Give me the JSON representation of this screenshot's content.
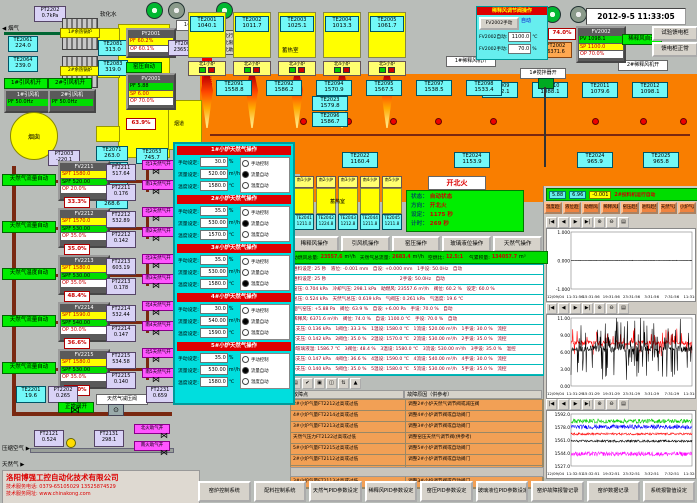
{
  "window": {
    "datetime": "2012-9-5 11:33:05"
  },
  "icons": {
    "valve": "⋈",
    "meter": "⊙",
    "arrow_left": "◀",
    "arrow_right": "▶"
  },
  "chart_toolbar_icons": [
    "|◀",
    "◀",
    "▶",
    "▶|",
    "⊕",
    "⊖",
    "▤"
  ],
  "top_left": {
    "smoke": "◀ 烟气",
    "pt2202_t": "PT2202",
    "pt2202_v": "0.7kPa",
    "soft_water": "软化水",
    "boiler1": "1#余热锅炉",
    "boiler2": "2#余热锅炉",
    "te2061_t": "TE2061",
    "te2061_v": "224.0",
    "te2064_t": "TE2064",
    "te2064_v": "239.0",
    "te2081_t": "TE2081",
    "te2081_v": "313.0",
    "te2083_t": "TE2083",
    "te2083_v": "319.0",
    "fan1_on": "1#引风机开",
    "fan2_on": "2#引风机开",
    "fan1_t": "1#引风机",
    "fan1_v": "PF 50.0Hz",
    "fan2_t": "2#引风机",
    "fan2_v": "PF 50.0Hz",
    "chimney": "烟囱",
    "flue": "烟道",
    "pt2003_t": "PT2003",
    "pt2003_v": "-220.1",
    "te2053_t": "TE2053",
    "te2053_v": "745.7",
    "pct_flue": "63.9%",
    "kiln_auto": "窑压自动",
    "py2001_t": "PY2001",
    "py2001_r1": "PF 60.2%",
    "py2001_r2": "OP 60.1%",
    "ft2001_t": "FT2001",
    "ft2001_v": "23657.6",
    "pv2001_t": "PV2001",
    "pv2001_r1": "PF 5.88",
    "pv2001_r2": "SP 6.00",
    "pv2001_r3": "OP 70.0%",
    "comb_fan_on": "1#助燃风机开",
    "comb_air_open": "助燃风开",
    "legend": [
      {
        "label": "北行程",
        "cls": "sq-gray"
      },
      {
        "label": "北限位",
        "cls": "sq-gray"
      },
      {
        "label": "北助燃",
        "cls": "sq-green"
      }
    ]
  },
  "north": {
    "room": "蓄热室",
    "chambers": [
      {
        "t": "TE2001",
        "v": "1040.1",
        "f": "北1小炉"
      },
      {
        "t": "TE2002",
        "v": "1011.7",
        "f": "北2小炉"
      },
      {
        "t": "TE2003",
        "v": "1025.1",
        "f": "北3小炉"
      },
      {
        "t": "TE2004",
        "v": "1013.3",
        "f": "北4小炉"
      },
      {
        "t": "TE2005",
        "v": "1061.7",
        "f": "北5小炉"
      }
    ]
  },
  "south": {
    "room": "蓄热室",
    "chambers": [
      {
        "f": "南1小炉",
        "t": "TE2041",
        "v": "1211.0"
      },
      {
        "f": "南2小炉",
        "t": "TE2042",
        "v": "1224.8"
      },
      {
        "f": "南3小炉",
        "t": "TE2043",
        "v": "1212.8"
      },
      {
        "f": "南4小炉",
        "t": "TE2044",
        "v": "1211.8"
      },
      {
        "f": "南5小炉",
        "t": "TE2045",
        "v": "1211.8"
      }
    ]
  },
  "furnace": {
    "left_stack": [
      {
        "t": "TE2071",
        "v": "263.0"
      },
      {
        "t": "TE2072",
        "v": "267.4"
      },
      {
        "t": "TE2073",
        "v": "269.6"
      },
      {
        "t": "TE2074",
        "v": "268.6"
      }
    ],
    "mid_temps": [
      {
        "t": "TE2091",
        "v": "1558.8"
      },
      {
        "t": "TE2092",
        "v": "1586.2"
      },
      {
        "t": "TE2094",
        "v": "1570.9"
      },
      {
        "t": "TE2095",
        "v": "1567.5"
      },
      {
        "t": "TE2097",
        "v": "1538.5"
      },
      {
        "t": "TE2098",
        "v": "1533.4"
      }
    ],
    "stack2": [
      {
        "t": "TE2023",
        "v": "1579.8"
      },
      {
        "t": "TE2096",
        "v": "1586.7"
      }
    ],
    "bottom_temps": [
      {
        "t": "TE2021",
        "v": "1168.3"
      },
      {
        "t": "TE2022",
        "v": "1160.4"
      },
      {
        "t": "TE2024",
        "v": "1153.9"
      }
    ],
    "right_temps": [
      {
        "t": "TE2009",
        "v": "1522.1"
      },
      {
        "t": "TE2010",
        "v": "1088.1"
      },
      {
        "t": "TE2011",
        "v": "1079.6"
      },
      {
        "t": "TE2012",
        "v": "1098.1"
      }
    ],
    "right_bottom": [
      {
        "t": "TE2024",
        "v": "965.9"
      },
      {
        "t": "TE2025",
        "v": "965.8"
      }
    ],
    "stirrer_on": "1#搅拌器开",
    "dilute_fan1": "1#稀释风机开",
    "dilute_fan2": "2#稀释风机开"
  },
  "dilution": {
    "title": "稀释风调节阀操作",
    "manual_btn": "FV2002手动",
    "mode": "自动",
    "auto_l": "FV2002自动:",
    "auto_v": "1100.0",
    "auto_u": "℃",
    "man_l": "FV2002手动:",
    "man_v": "70.0",
    "man_u": "%",
    "fv_t": "FV2002",
    "fv_pv": "PV 1098.1",
    "fv_sp": "SP 1100.0",
    "fv_op": "OP 70.0%",
    "auto_lbl": "稀释风自动",
    "ft2002_t": "FT2002",
    "ft2002_v": "6371.6",
    "pct": "74.0%",
    "btn1": "试验馈电柜",
    "btn2": "馈电柜正常"
  },
  "status": {
    "fire_btn": "开北火",
    "rows": [
      {
        "l": "状态：",
        "v": "自动状态"
      },
      {
        "l": "方向：",
        "v": "开北火"
      },
      {
        "l": "设定：",
        "v": "1175 秒"
      },
      {
        "l": "计时：",
        "v": "269 秒"
      }
    ]
  },
  "ops_buttons": [
    "稀释风操作",
    "引风机操作",
    "窑压操作",
    "玻璃液位操作",
    "天然气操作"
  ],
  "totals": [
    {
      "l": "助燃风总量:",
      "v": "23557.6",
      "u": "m³/h"
    },
    {
      "l": "天然气总流量:",
      "v": "2683.4",
      "u": "m³/h"
    },
    {
      "l": "空燃比:",
      "v": "12.5:1",
      "u": ""
    },
    {
      "l": "气累积量:",
      "v": "134057.7",
      "u": "m³"
    }
  ],
  "data_rows": [
    "进料设定: 25 秒　液位: -0.001 mm　自设: +0.000 mm　1手设: 50.0Hz　自动",
    "进料设定: 25 秒　　　　　　　　　　　　　　　　2手设: 50.0Hz　自动",
    "窑压: 0.704 kPa　冷却气压: 298.1 kPa　助燃风: 23557.6 m³/h　阀位: 60.2 %　设定: 60.0 %",
    "总压: 0.524 kPa　天然气总压: 0.619 kPa　气阀压: 0.261 kPa　气温度: 19.6 ℃",
    "烟气窑压: +5.88 Pa　阀位: 63.9 %　自设: +6.00 Pa　手设: 70.0 %　自动",
    "稀释风: 6371.6 m³/h　阀位: 74.0 %　自设: 1100.0 ℃　手设: 70.0 %　自动",
    "1支压: 0.136 kPa　1阀位: 33.3 %　1温设: 1580.0 ℃　1流设: 520.00 m³/h　1手设: 30.0 %　流控",
    "2支压: 0.142 kPa　2阀位: 35.0 %　2温设: 1570.0 ℃　2流设: 530.00 m³/h　2手设: 35.0 %　流控",
    "3玻璃液温: 1586.7 ℃　3阀位: 48.4 %　3温设: 1580.0 ℃　3流设: 530.00 m³/h　3手设: 35.0 %　温控",
    "4支压: 0.147 kPa　4阀位: 36.6 %　4温设: 1590.0 ℃　4流设: 540.00 m³/h　4手设: 30.0 %　流控",
    "5支压: 0.140 kPa　5阀位: 35.0 %　5温设: 1580.0 ℃　5流设: 530.00 m³/h　5手设: 35.0 %　流控"
  ],
  "alarm": {
    "toolbar": [
      "▤",
      "✔",
      "▣",
      "◫",
      "⇅",
      "▲"
    ],
    "headers": [
      "故障点",
      "故障原因（供参考）"
    ],
    "rows": [
      {
        "f": "2#小炉气量FT2212过高或过低",
        "c": "调整2#小炉天然气调节阀或减压阀"
      },
      {
        "f": "4#小炉气量FT2214过高或过低",
        "c": "调整4#小炉调节阀或自动阀门"
      },
      {
        "f": "3#小炉气量FT2213过高或过低",
        "c": "调整3#小炉调节阀或自动阀门"
      },
      {
        "f": "天然气压力FT2122过高或过低",
        "c": "调整窑压天然气调节阀(供参考)"
      },
      {
        "f": "5#小炉气量FT2215过高或过低",
        "c": "调整5#小炉调节阀或自动阀门"
      },
      {
        "f": "2#小炉气量FT2112过高或过低",
        "c": "调整2#小炉调节阀或自动阀门"
      },
      {
        "f": "1#小炉气量FT2111过高或过低",
        "c": "调整1#小炉调节阀或自动阀门"
      },
      {
        "f": "3#小炉气量FT2113过高或过低",
        "c": "调整3#小炉调节阀或自动阀门"
      }
    ]
  },
  "gas": {
    "trains": [
      {
        "mode": "天然气流量自动",
        "ctrl": "FV2211",
        "spt": "SPT 1580.0",
        "spf": "SPF 520.00",
        "op": "OP 20.0%",
        "pct": "33.3%",
        "ft_t": "FT2211",
        "ft_v": "517.64",
        "pt_t": "PT2211",
        "pt_v": "0.176",
        "vn": "北1天然气开",
        "vs": "南1天然气开"
      },
      {
        "mode": "天然气流量自动",
        "ctrl": "FV2212",
        "spt": "SPT 1570.0",
        "spf": "SPF 530.00",
        "op": "OP 35.0%",
        "pct": "35.0%",
        "ft_t": "FT2212",
        "ft_v": "532.89",
        "pt_t": "PT2212",
        "pt_v": "0.142",
        "vn": "北2天然气开",
        "vs": "南2天然气开"
      },
      {
        "mode": "天然气温度自动",
        "ctrl": "FV2213",
        "spt": "SPT 1580.0",
        "spf": "SPF 530.00",
        "op": "OP 35.0%",
        "pct": "48.4%",
        "ft_t": "FT2213",
        "ft_v": "603.19",
        "pt_t": "PT2213",
        "pt_v": "0.178",
        "vn": "北3天然气开",
        "vs": "南3天然气开"
      },
      {
        "mode": "天然气流量自动",
        "ctrl": "FV2214",
        "spt": "SPT 1590.0",
        "spf": "SPF 540.00",
        "op": "OP 30.0%",
        "pct": "36.6%",
        "ft_t": "FT2214",
        "ft_v": "532.44",
        "pt_t": "PT2214",
        "pt_v": "0.147",
        "vn": "北4天然气开",
        "vs": "南4天然气开"
      },
      {
        "mode": "天然气流量自动",
        "ctrl": "FV2215",
        "spt": "SPT 1580.0",
        "spf": "SPF 530.00",
        "op": "OP 35.0%",
        "pct": "35.0%",
        "ft_t": "FT2215",
        "ft_v": "534.58",
        "pt_t": "PT2215",
        "pt_v": "0.140",
        "vn": "北5天然气开",
        "vs": "南5天然气开"
      }
    ],
    "te2201_t": "TE2201",
    "te2201_v": "19.6",
    "pt2202_t": "PT2202",
    "pt2202_v": "0.265",
    "valve_ok": "正常阀开",
    "reducer": "天然气减压阀",
    "ft2231_t": "FT2231",
    "ft2231_v": "0.659",
    "air_label": "压缩空气 ▶",
    "ft2121_t": "FT2121",
    "ft2121_v": "0.524",
    "ft2131_t": "FT2131",
    "ft2131_v": "298.1",
    "vn": "北火助气开",
    "vs": "南火助气开",
    "gas_label": "天然气 ▶"
  },
  "popup": {
    "man_l": "手动设定:",
    "flow_l": "流量设定:",
    "temp_l": "温度设定:",
    "man_u": "%",
    "flow_u": "m³/h",
    "temp_u": "℃",
    "sections": [
      {
        "title": "1#小炉天然气操作",
        "man": "30.0",
        "flow": "520.00",
        "temp": "1580.0",
        "radios": [
          {
            "label": "手动控制",
            "cls": ""
          },
          {
            "label": "流量自动",
            "cls": "on"
          },
          {
            "label": "温度自动",
            "cls": ""
          }
        ]
      },
      {
        "title": "2#小炉天然气操作",
        "man": "35.0",
        "flow": "530.00",
        "temp": "1570.0",
        "radios": [
          {
            "label": "手动控制",
            "cls": ""
          },
          {
            "label": "流量自动",
            "cls": "on"
          },
          {
            "label": "温度自动",
            "cls": ""
          }
        ]
      },
      {
        "title": "3#小炉天然气操作",
        "man": "35.0",
        "flow": "530.00",
        "temp": "1580.0",
        "radios": [
          {
            "label": "手动控制",
            "cls": ""
          },
          {
            "label": "流量自动",
            "cls": ""
          },
          {
            "label": "温度自动",
            "cls": "on"
          }
        ]
      },
      {
        "title": "4#小炉天然气操作",
        "man": "30.0",
        "flow": "540.00",
        "temp": "1590.0",
        "radios": [
          {
            "label": "手动控制",
            "cls": ""
          },
          {
            "label": "流量自动",
            "cls": "on"
          },
          {
            "label": "温度自动",
            "cls": ""
          }
        ]
      },
      {
        "title": "5#小炉天然气操作",
        "man": "35.0",
        "flow": "530.00",
        "temp": "1580.0",
        "radios": [
          {
            "label": "手动控制",
            "cls": ""
          },
          {
            "label": "流量自动",
            "cls": "on"
          },
          {
            "label": "温度自动",
            "cls": ""
          }
        ]
      }
    ]
  },
  "right_strip": {
    "v1": "5.88",
    "v2": "6.96",
    "v3": "-0.001",
    "label": "2#投料机运行自动"
  },
  "trend_buttons": [
    "温度趋势",
    "液位趋势",
    "助燃风趋势",
    "稀释风趋势",
    "窑压趋势",
    "进料趋势",
    "天然气趋势",
    "小炉气趋势"
  ],
  "bottom_buttons": [
    "窑炉控制系统",
    "配料控制系统",
    "天然气PID参数设定",
    "稀释风PID参数设定",
    "窑压PID参数设定",
    "玻璃液位PID参数设定",
    "窑炉故障报警记录",
    "窑炉数据记录",
    "系统报警值设定"
  ],
  "company": {
    "name": "洛阳博强工控自动化技术有限公司",
    "phone": "技术服务电话: 0379-65105029  13525874529",
    "web": "技术服务网址: www.chinakong.com"
  },
  "chart_data": [
    {
      "type": "line",
      "ylim": [
        -1,
        1
      ],
      "y_ticks": [
        "1.000",
        "0.000",
        "-1.000"
      ],
      "x_ticks": [
        "11:31:56",
        "15:31:56",
        "19:31:56",
        "23:31:56",
        "3:31:56",
        "7:31:56",
        "11:31:56"
      ],
      "date": "12/09/04",
      "grid": false,
      "legend": "none",
      "series": [
        {
          "color": "#000000",
          "baseline": 0.0,
          "amp": 0.008
        }
      ]
    },
    {
      "type": "line",
      "ylim": [
        0,
        11
      ],
      "y_ticks": [
        "11.00",
        "9.00",
        "6.00",
        "3.00",
        "0.00"
      ],
      "x_ticks": [
        "11:31:29",
        "15:31:29",
        "19:31:29",
        "23:31:29",
        "3:31:29",
        "7:31:29",
        "11:31:29"
      ],
      "date": "12/09/04",
      "grid": false,
      "legend": "none",
      "series": [
        {
          "color": "#ff0000",
          "baseline": 7.0,
          "amp": 0.35,
          "spike_amp": 2.2,
          "spike_p": 0.18
        },
        {
          "color": "#000000",
          "baseline": 6.0,
          "amp": 0.5,
          "spike_amp": 5.0,
          "spike_p": 0.3
        }
      ]
    },
    {
      "type": "line",
      "ylim": [
        1523,
        1596
      ],
      "y_ticks": [
        "1592.0",
        "1578.0",
        "1561.0",
        "1544.0",
        "1527.0"
      ],
      "x_ticks": [
        "11:32:51",
        "15:32:51",
        "19:32:51",
        "23:32:51",
        "3:32:51",
        "7:32:51",
        "11:32:51"
      ],
      "date": "12/09/04",
      "grid": false,
      "legend": "none",
      "series": [
        {
          "color": "#00cc00",
          "baseline": 1586,
          "amp": 3
        },
        {
          "color": "#0000ff",
          "baseline": 1578,
          "amp": 3
        },
        {
          "color": "#ff0000",
          "baseline": 1568,
          "amp": 1.5
        },
        {
          "color": "#000000",
          "baseline": 1558,
          "amp": 1.5
        },
        {
          "color": "#ff00ff",
          "baseline": 1540,
          "amp": 3
        }
      ]
    }
  ]
}
